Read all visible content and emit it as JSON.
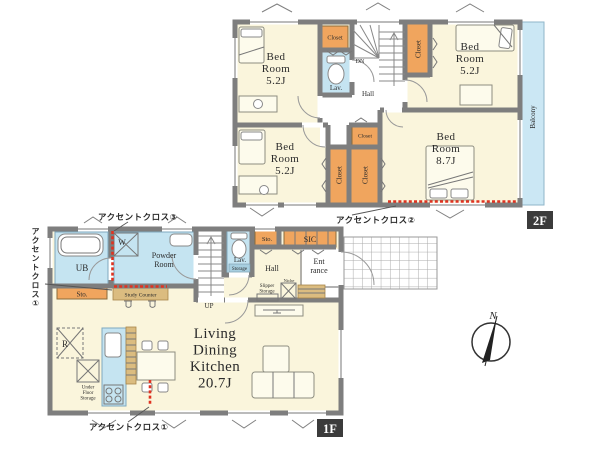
{
  "colors": {
    "room-cream": "#FAF5DC",
    "closet-orange": "#F0A55E",
    "water-blue": "#C5E4F1",
    "balcony-blue": "#CBE7F4",
    "wall-gray": "#7E7E7E",
    "wood-tan": "#DBBC80",
    "accent-red": "#E03220",
    "badge-dark": "#3B3B3B",
    "text-dark": "#2B2B2B"
  },
  "floor2": {
    "badge": "2F",
    "bedroom_nw": "Bed\nRoom\n5.2J",
    "bedroom_ne": "Bed\nRoom\n5.2J",
    "bedroom_sw": "Bed\nRoom\n5.2J",
    "bedroom_se": "Bed\nRoom\n8.7J",
    "closet_nw": "Closet",
    "closet_ne": "Closet",
    "closet_mid": "Closet",
    "closet_v1": "Closet",
    "closet_v2": "Closet",
    "lav": "Lav.",
    "dn": "DN",
    "hall": "Hall",
    "balcony": "Balcony",
    "accent_note_2": "アクセントクロス②"
  },
  "floor1": {
    "badge": "1F",
    "ldk": "Living\nDining\nKitchen\n20.7J",
    "ub": "UB",
    "washer": "W",
    "powder_room": "Powder\nRoom",
    "storage_left": "Sto.",
    "study_counter": "Study Counter",
    "lav": "Lav.",
    "lav_storage": "Storage",
    "hall": "Hall",
    "entrance": "Ent\nrance",
    "storage_top": "Sto.",
    "sic": "SIC",
    "slipper_storage": "Slipper\nStorage",
    "niche": "Niche",
    "up": "UP",
    "refrigerator": "R",
    "under_floor_storage": "Under\nFloor\nStorage",
    "accent_note_1_bottom": "アクセントクロス①",
    "accent_note_1_left": "アクセントクロス①",
    "accent_note_3": "アクセントクロス③"
  },
  "compass": {
    "north": "N"
  }
}
